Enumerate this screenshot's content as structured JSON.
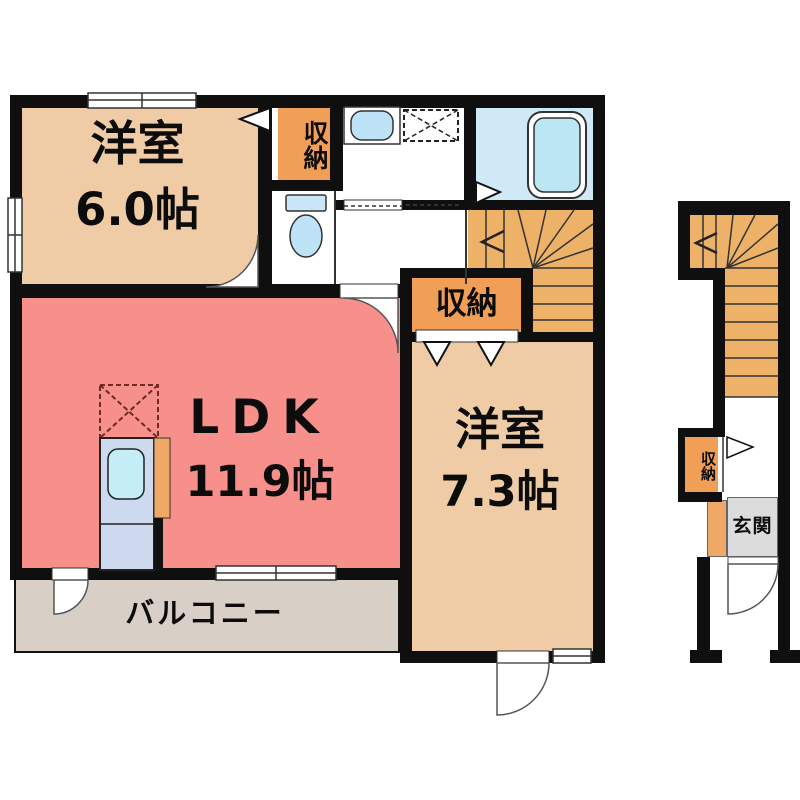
{
  "floor2": {
    "bedroom1": {
      "name": "洋室",
      "size": "6.0帖"
    },
    "ldk": {
      "name": "LDK",
      "size": "11.9帖"
    },
    "bedroom2": {
      "name": "洋室",
      "size": "7.3帖"
    },
    "closet_top_label": "収納",
    "closet_mid_label": "収納",
    "balcony_label": "バルコニー"
  },
  "floor1": {
    "closet_label": "収納",
    "entrance_label": "玄関"
  },
  "legend_colors": {
    "wall": "#0f0f0f",
    "western_room_beige": "#efcca5",
    "ldk_salmon": "#f7908a",
    "closet_orange": "#f19e56",
    "stairs_orange": "#edb168",
    "balcony_gray": "#d8d0c7",
    "entrance_gray": "#dcdcdc",
    "bathroom_blue": "#cfeaf6",
    "fixture_blue": "#bfe3f6",
    "kitchen_unit_blue": "#cdd9ee"
  }
}
